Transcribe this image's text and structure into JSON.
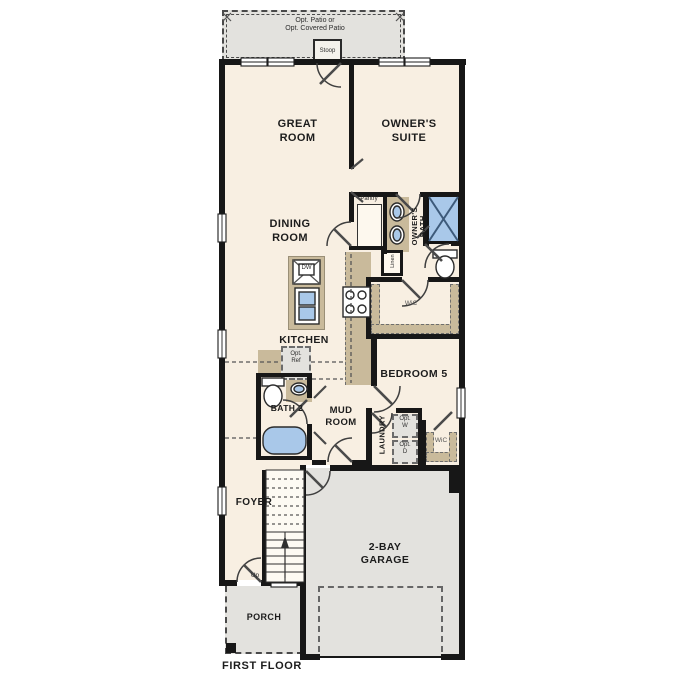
{
  "title": "FIRST FLOOR",
  "colors": {
    "floor": "#f8efe2",
    "outdoor": "#e3e2de",
    "wall": "#171717",
    "cabinet": "#c9ba9b",
    "fixture": "#a9c8e9",
    "line": "#3f3f3f",
    "ink": "#1c1c1c"
  },
  "labels": {
    "patio": "Opt. Patio or\nOpt. Covered Patio",
    "stoop": "Stoop",
    "great_room": "GREAT\nROOM",
    "owners_suite": "OWNER'S\nSUITE",
    "dining_room": "DINING\nROOM",
    "pantry": "Pantry",
    "owners_bath": "OWNER'S\nBATH",
    "linen": "Linen",
    "wic1": "WiC",
    "kitchen": "KITCHEN",
    "dw": "DW",
    "opt_ref": "Opt.\nRef",
    "bath2": "BATH 2",
    "mud_room": "MUD\nROOM",
    "bedroom5": "BEDROOM 5",
    "laundry": "LAUNDRY",
    "opt_w": "Opt.\nW",
    "opt_d": "Opt.\nD",
    "wic2": "WiC",
    "foyer": "FOYER",
    "up": "Up",
    "porch": "PORCH",
    "garage": "2-BAY\nGARAGE",
    "first_floor": "FIRST FLOOR"
  }
}
